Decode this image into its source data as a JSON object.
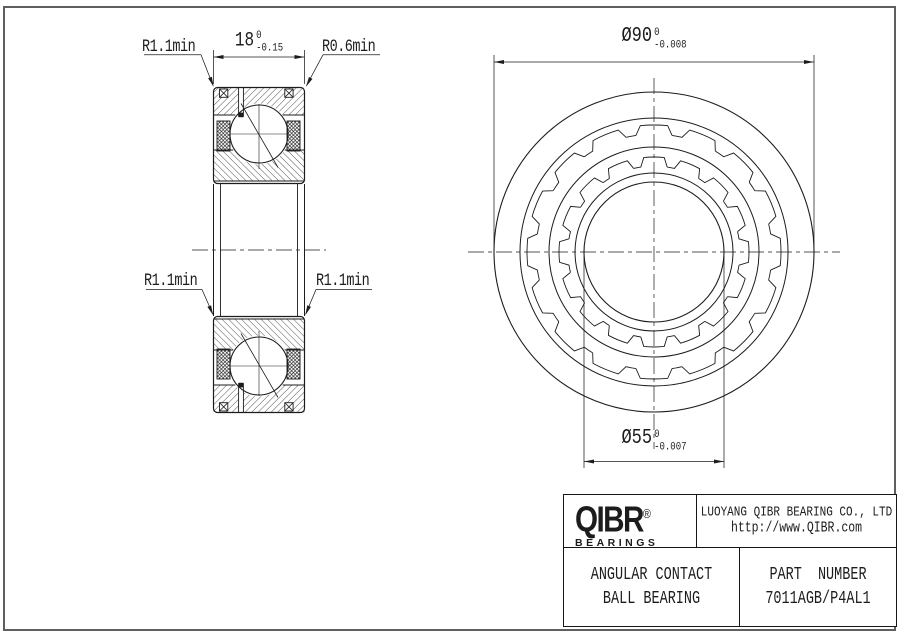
{
  "section_view": {
    "width_dim": {
      "text": "18",
      "tol_upper": "0",
      "tol_lower": "-0.15"
    },
    "labels": {
      "top_left": "R1.1min",
      "top_right": "R0.6min",
      "mid_left": "R1.1min",
      "mid_right": "R1.1min"
    }
  },
  "front_view": {
    "od_dim": {
      "text": "Ø90",
      "tol_upper": "0",
      "tol_lower": "-0.008"
    },
    "bore_dim": {
      "text": "Ø55",
      "tol_upper": "0",
      "tol_lower": "-0.007"
    }
  },
  "title_block": {
    "logo": {
      "name": "QIBR",
      "registered": "®",
      "sub": "BEARINGS"
    },
    "company": "LUOYANG QIBR BEARING CO., LTD",
    "website": "http://www.QIBR.com",
    "product_line1": "ANGULAR CONTACT",
    "product_line2": "BALL BEARING",
    "part_label": "PART NUMBER",
    "part_number": "7011AGB/P4AL1"
  },
  "colors": {
    "line": "#1c1c1c",
    "frame": "#5f5f5f",
    "background": "#ffffff"
  }
}
